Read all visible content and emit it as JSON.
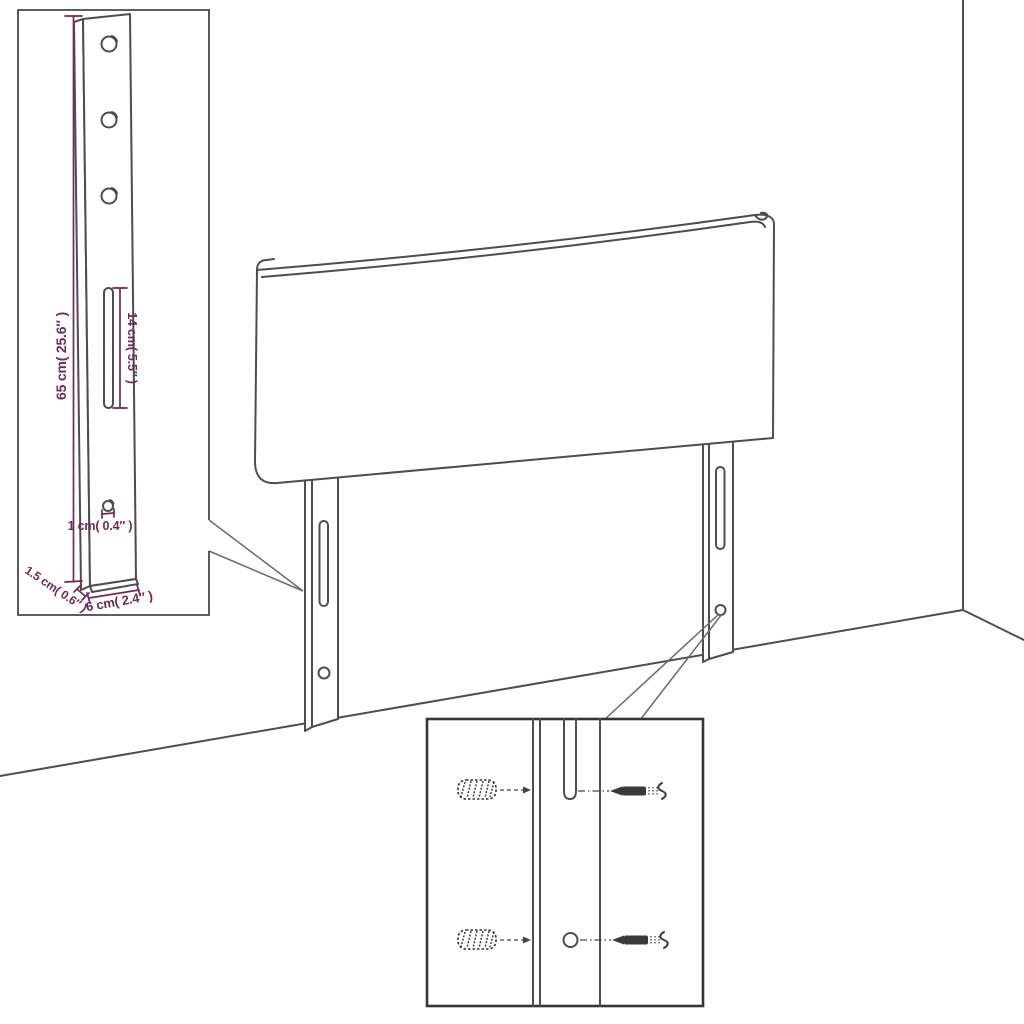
{
  "figure": {
    "description": "headboard assembly diagram with dimension insets",
    "background_color": "#ffffff",
    "outline_color": "#4d4d4d",
    "dimension_color": "#6d2a5a",
    "labels": {
      "leg_height": "65 cm( 25.6″ )",
      "slot_length": "14 cm( 5.5″ )",
      "hole_diameter": "1 cm( 0.4″ )",
      "leg_thickness": "1.5 cm( 0.6″ )",
      "leg_width": "6 cm( 2.4″ )"
    }
  }
}
